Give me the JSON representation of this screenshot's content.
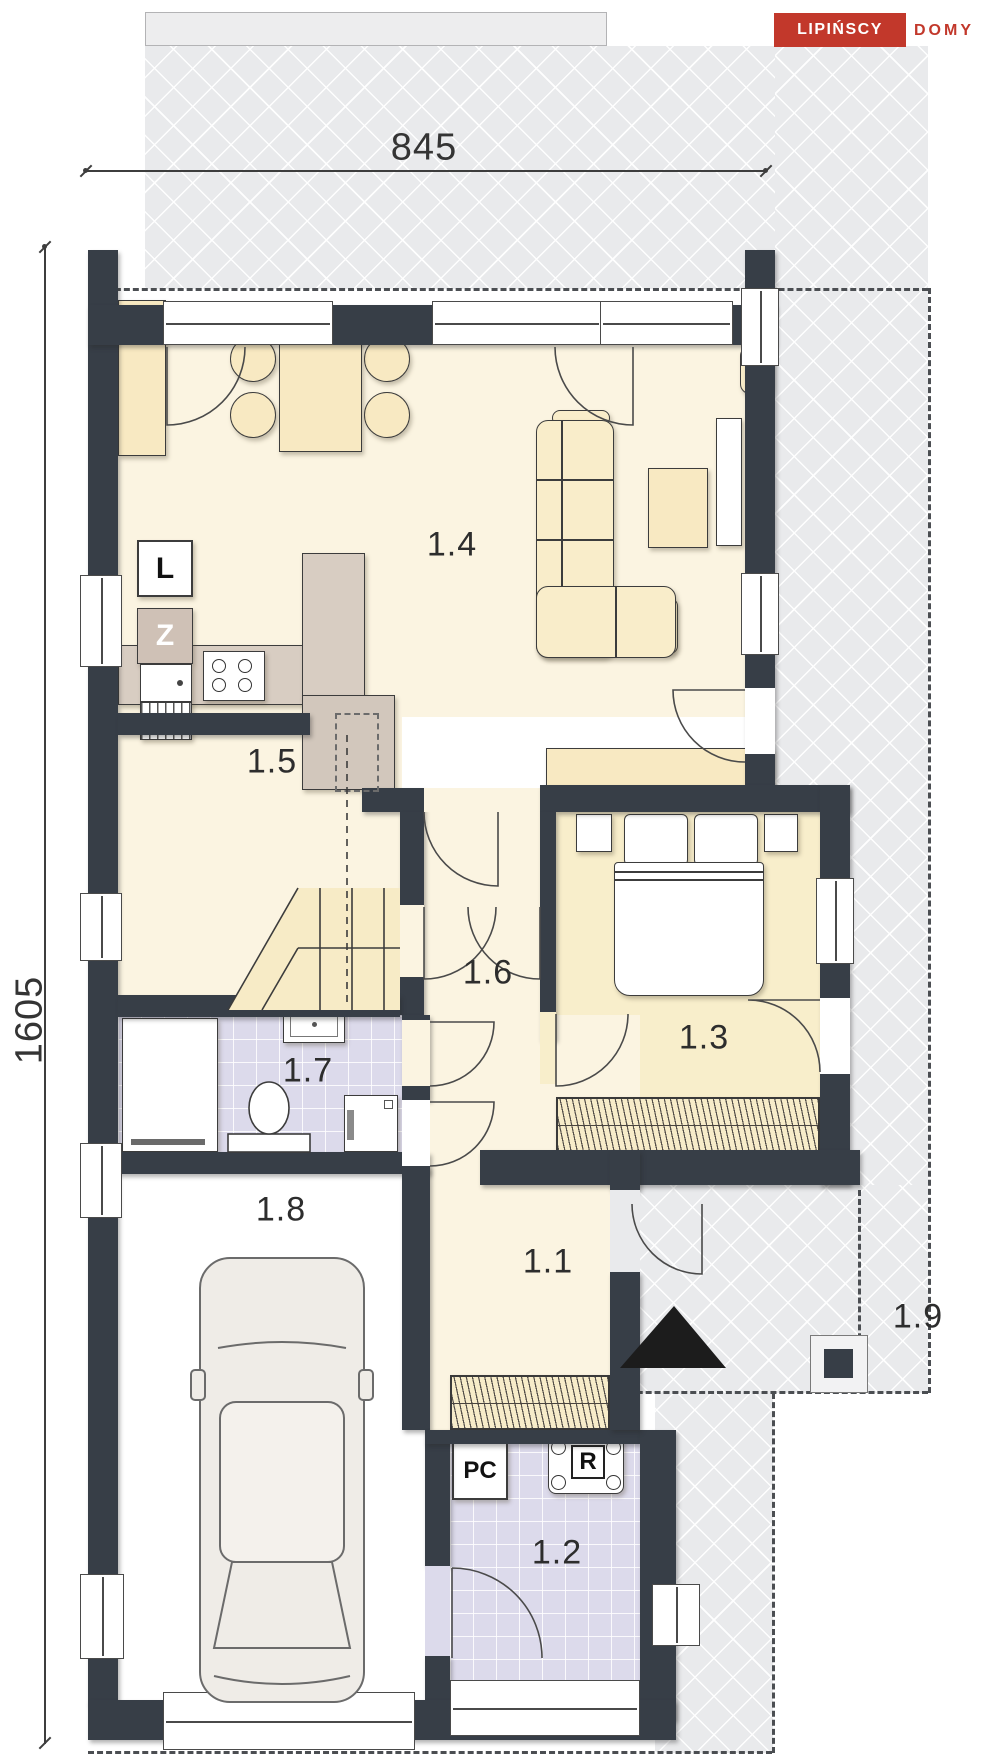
{
  "logo": {
    "brand": "LIPIŃSCY",
    "suffix": "DOMY"
  },
  "dimensions": {
    "width": "845",
    "height": "1605"
  },
  "rooms": [
    {
      "label": "1.1"
    },
    {
      "label": "1.2"
    },
    {
      "label": "1.3"
    },
    {
      "label": "1.4"
    },
    {
      "label": "1.5"
    },
    {
      "label": "1.6"
    },
    {
      "label": "1.7"
    },
    {
      "label": "1.8"
    },
    {
      "label": "1.9"
    }
  ],
  "appliances": {
    "fridge": "L",
    "freezer": "Z",
    "boiler": "PC",
    "manifold": "R"
  },
  "colors": {
    "accent_red": "#c2382b",
    "wall": "#373e47",
    "floor_cream": "#fbf4e1",
    "floor_wheat": "#f8eecb",
    "floor_tile": "#dcdaeb",
    "counter": "#d8cdc2",
    "paving": "#e9eaec"
  }
}
